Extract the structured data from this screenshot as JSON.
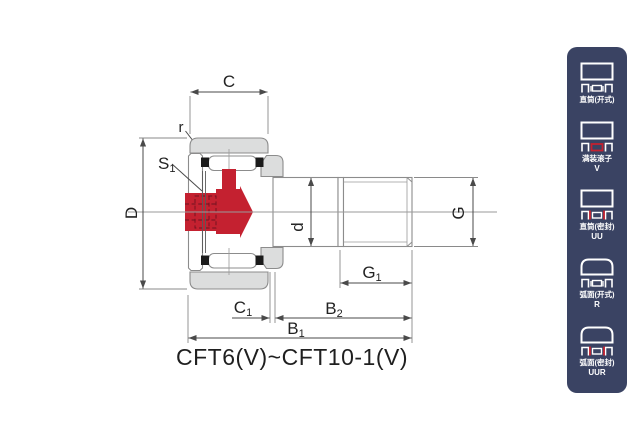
{
  "diagram": {
    "title": "CFT6(V)~CFT10-1(V)",
    "dims": {
      "c": {
        "main": "C",
        "sub": ""
      },
      "r": {
        "main": "r",
        "sub": ""
      },
      "s1": {
        "main": "S",
        "sub": "1"
      },
      "D": {
        "main": "D",
        "sub": ""
      },
      "d": {
        "main": "d",
        "sub": ""
      },
      "g": {
        "main": "G",
        "sub": ""
      },
      "g1": {
        "main": "G",
        "sub": "1"
      },
      "c1": {
        "main": "C",
        "sub": "1"
      },
      "b2": {
        "main": "B",
        "sub": "2"
      },
      "b1": {
        "main": "B",
        "sub": "1"
      }
    }
  },
  "sidebar": {
    "items": [
      {
        "label": "直筒(开式)",
        "code": "",
        "icon": "straight-open-bearing-icon"
      },
      {
        "label": "满装滚子",
        "code": "V",
        "icon": "full-complement-roller-icon"
      },
      {
        "label": "直筒(密封)",
        "code": "UU",
        "icon": "straight-sealed-bearing-icon"
      },
      {
        "label": "弧面(开式)",
        "code": "R",
        "icon": "crowned-open-bearing-icon"
      },
      {
        "label": "弧面(密封)",
        "code": "UUR",
        "icon": "crowned-sealed-bearing-icon"
      }
    ]
  },
  "colors": {
    "panel_navy": "#3a4363",
    "accent_red": "#c42130",
    "part_gray": "#dcdddd",
    "outline_gray": "#8c8c8c",
    "line_dark": "#4a4a4a",
    "text_dark": "#232323"
  }
}
